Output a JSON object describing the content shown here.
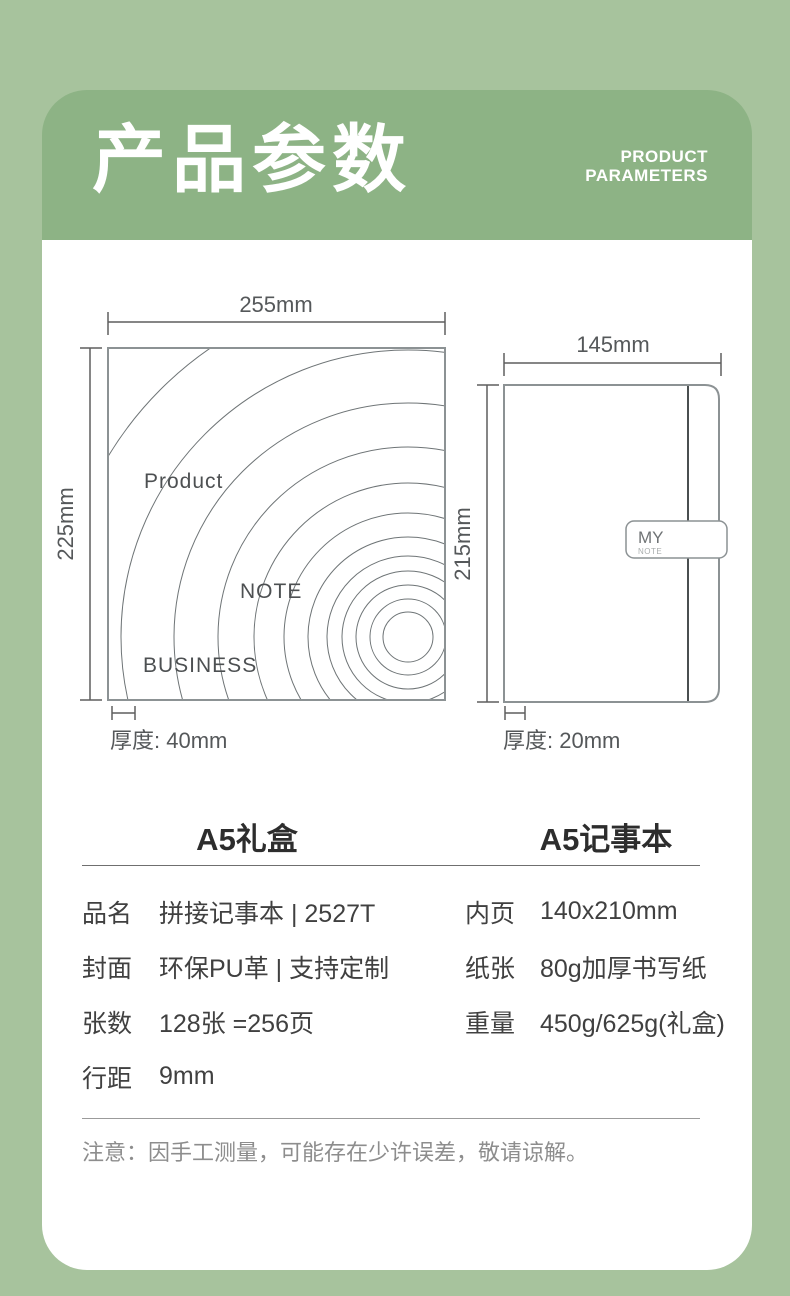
{
  "colors": {
    "background": "#a7c39d",
    "header_panel": "#8db385",
    "card": "#ffffff",
    "title_text": "#ffffff",
    "outline_gray": "#8c9294",
    "ripple_gray": "#6e7476",
    "dimension_gray": "#5f5f5f",
    "body_text": "#404040",
    "muted_text": "#8d8d8d"
  },
  "header": {
    "title": "产品参数",
    "subtitle_lines": [
      "PRODUCT",
      "PARAMETERS"
    ]
  },
  "diagrams": {
    "giftbox": {
      "title": "A5礼盒",
      "width": "255mm",
      "height": "225mm",
      "thickness": "厚度: 40mm",
      "label_product": "Product",
      "label_note": "NOTE",
      "label_business": "BUSINESS"
    },
    "notebook": {
      "title": "A5记事本",
      "width": "145mm",
      "height": "215mm",
      "thickness": "厚度: 20mm",
      "tab_line1": "MY",
      "tab_line2": "NOTE"
    }
  },
  "spec_table": {
    "left_rows": [
      {
        "label": "品名",
        "value": "拼接记事本 | 2527T"
      },
      {
        "label": "封面",
        "value": "环保PU革 | 支持定制"
      },
      {
        "label": "张数",
        "value": "128张 =256页"
      },
      {
        "label": "行距",
        "value": "9mm"
      }
    ],
    "right_rows": [
      {
        "label": "内页",
        "value": "140x210mm"
      },
      {
        "label": "纸张",
        "value": "80g加厚书写纸"
      },
      {
        "label": "重量",
        "value": "450g/625g(礼盒)"
      }
    ]
  },
  "footnote": "注意：因手工测量，可能存在少许误差，敬请谅解。"
}
